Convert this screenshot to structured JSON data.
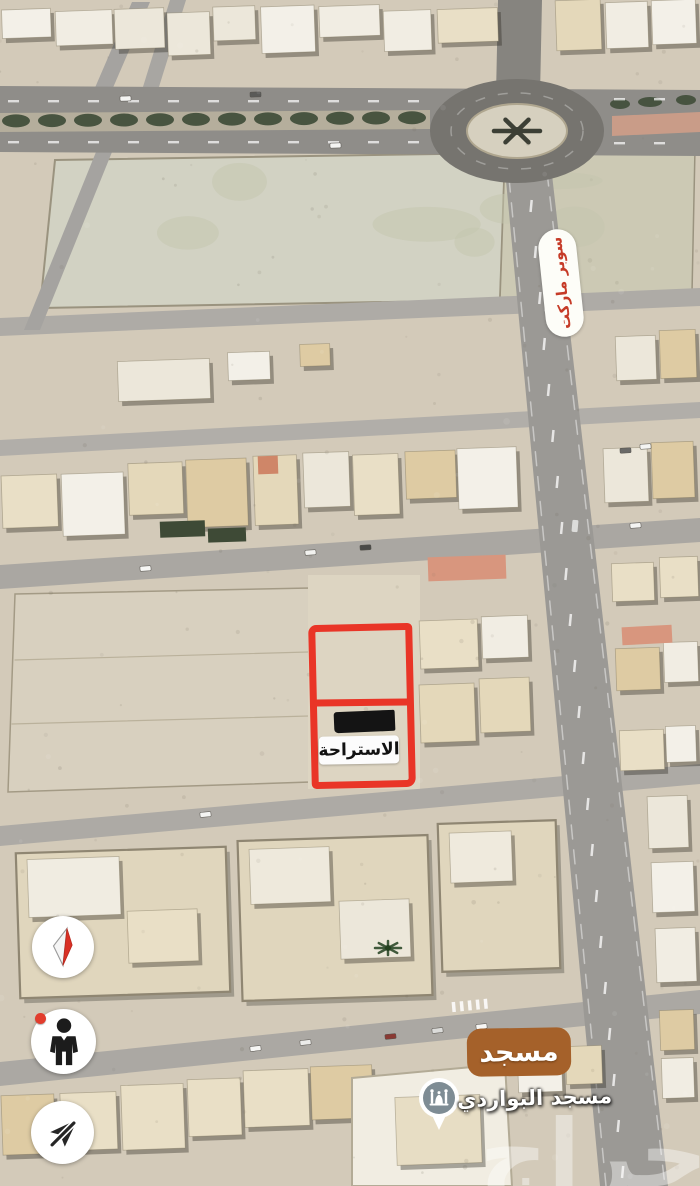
{
  "map": {
    "annotations": {
      "plot_label": "الاستراحة",
      "supermarket_label": "سوبر ماركت",
      "mosque_badge_label": "مسجد",
      "poi_name": "مسجد البواردي"
    },
    "watermark_text": "حراج",
    "poi": {
      "pin_icon": "mosque-icon",
      "pin_color": "#7e8c94"
    },
    "colors": {
      "annotation_red": "#e93527",
      "supermarket_text_red": "#c63b28",
      "mosque_badge_brown": "#a5612a",
      "median_tree_green": "#3f4c38",
      "notification_dot_red": "#e23d2d"
    }
  },
  "controls": {
    "compass": {
      "icon": "compass-icon"
    },
    "pegman": {
      "icon": "pegman-icon",
      "notification_dot": true
    },
    "location": {
      "icon": "navigation-off-icon"
    }
  }
}
